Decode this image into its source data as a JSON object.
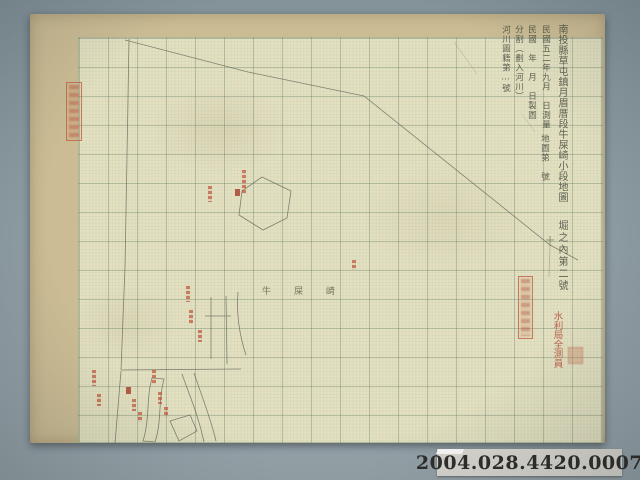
{
  "map": {
    "title_column": "南投縣草屯鎮月眉厝段牛屎崎小段地圖",
    "survey_column": "民國五二年九月　日測量",
    "sheet_number_column": "地圖第　號",
    "draft_column": "民國　年　月　日製圖",
    "division_column": "分割（劃入河川）",
    "river_register_column": "河川圖籍第…號",
    "section_label": "堀之內第二號",
    "place_name": "牛屎崎",
    "surveyor_stamp_text": "水利局全測員"
  },
  "catalog": {
    "number": "2004.028.4420.0007"
  },
  "colors": {
    "background": "#8e9ca3",
    "paper_margin": "#cbbc94",
    "grid_paper": "#e4e1c2",
    "ink": "#5f6156",
    "stamp_red": "#b8573e"
  }
}
